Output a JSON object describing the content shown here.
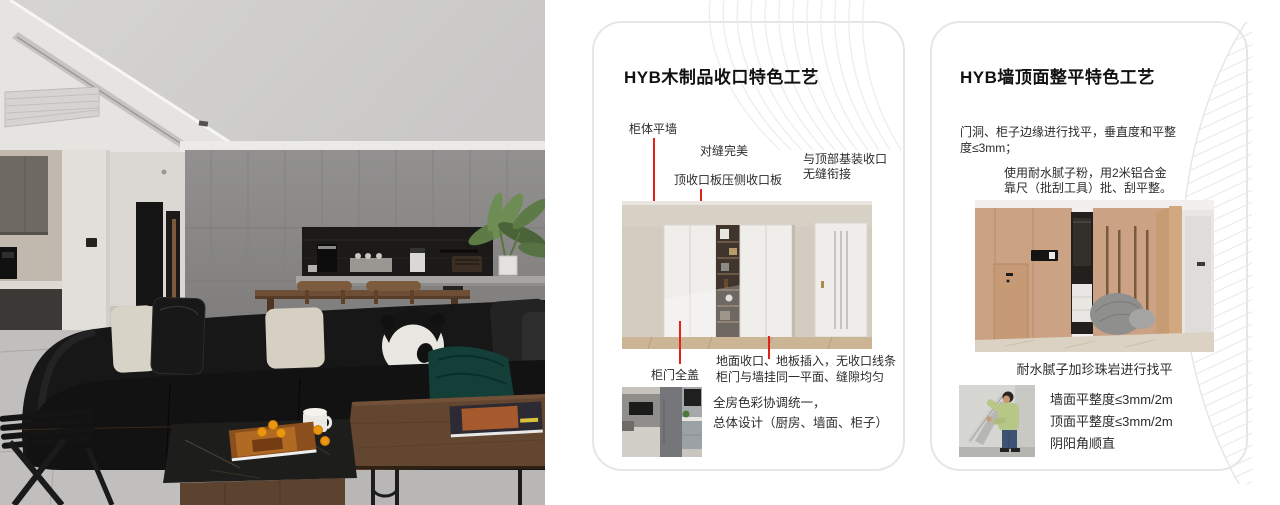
{
  "colors": {
    "accent_red": "#e2231a",
    "card_border": "#e6e6e6",
    "pattern_gray": "#ececec"
  },
  "card1": {
    "title": "HYB木制品收口特色工艺",
    "labels": {
      "label1": "柜体平墙",
      "label2": "对缝完美",
      "label3": "顶收口板压侧收口板",
      "label4_line1": "与顶部基装收口",
      "label4_line2": "无缝衔接",
      "label5": "柜门全盖"
    },
    "notes_line1": "地面收口、地板插入，无收口线条",
    "notes_line2": "柜门与墙挂同一平面、缝隙均匀",
    "summary_line1": "全房色彩协调统一，",
    "summary_line2": "总体设计（厨房、墙面、柜子）"
  },
  "card2": {
    "title": "HYB墙顶面整平特色工艺",
    "para1_line1": "门洞、柜子边缘进行找平，垂直度和平整",
    "para1_line2": "度≤3mm；",
    "para2_line1": "使用耐水腻子粉，用2米铝合金",
    "para2_line2": "靠尺（批刮工具）批、刮平整。",
    "photo_caption": "耐水腻子加珍珠岩进行找平",
    "spec_line1": "墙面平整度≤3mm/2m",
    "spec_line2": "顶面平整度≤3mm/2m",
    "spec_line3": "阴阳角顺直"
  }
}
